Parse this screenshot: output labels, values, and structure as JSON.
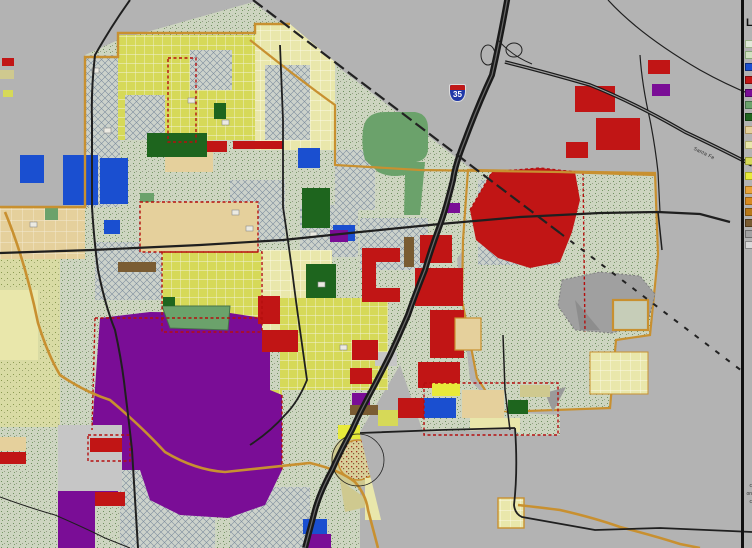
{
  "map": {
    "labels": {
      "interstate_shield": "35",
      "railroad": "Santa Fe",
      "legend_title_fragment": "L",
      "footnote_fragments": [
        "c",
        "on",
        "c"
      ]
    },
    "legend": {
      "title_fragment": "L",
      "swatches": [
        {
          "y": 40,
          "color": "#dfe8d8",
          "border": "#9ab08a"
        },
        {
          "y": 51,
          "color": "#cfe0c0",
          "border": "#88a878"
        },
        {
          "y": 63,
          "color": "#1a4fd0",
          "border": "#10307e"
        },
        {
          "y": 76,
          "color": "#c11515",
          "border": "#7d0d0d"
        },
        {
          "y": 89,
          "color": "#7a0d96",
          "border": "#4d0860"
        },
        {
          "y": 101,
          "color": "#6ba26b",
          "border": "#47714a"
        },
        {
          "y": 113,
          "color": "#1e651e",
          "border": "#124012"
        },
        {
          "y": 126,
          "color": "#e5d09c",
          "border": "#ab9462"
        },
        {
          "y": 141,
          "color": "#e9e7ab",
          "border": "#b0ad6d"
        },
        {
          "y": 157,
          "color": "#d6d958",
          "border": "#9a9c36"
        },
        {
          "y": 172,
          "color": "#e8ea3a",
          "border": "#a8aa20"
        },
        {
          "y": 186,
          "color": "#e8a33a",
          "border": "#a87420"
        },
        {
          "y": 197,
          "color": "#d88a20",
          "border": "#9a6112"
        },
        {
          "y": 208,
          "color": "#b87818",
          "border": "#82540e"
        },
        {
          "y": 219,
          "color": "#7a5c32",
          "border": "#503a1c"
        },
        {
          "y": 230,
          "color": "#a2a2a2",
          "border": "#6e6e6e"
        },
        {
          "y": 241,
          "color": "#d8d8d8",
          "border": "#888888"
        }
      ]
    },
    "palette": {
      "background_gray": "#b3b3b3",
      "agricultural_stipple": "#cdd5c0",
      "crosshatch_area": "#ccd2cb",
      "residential_yellow": "#d6d958",
      "pale_yellow": "#e9e7ab",
      "tan": "#e5d09c",
      "commercial_red": "#c11515",
      "industrial_purple": "#7a0d96",
      "park_green": "#6ba26b",
      "dark_green": "#1e651e",
      "public_blue": "#1a4fd0",
      "brown": "#7a5c32",
      "boundary_orange": "#c89030",
      "city_limit_red_dash": "#b50f0f",
      "road_black": "#1a1a1a",
      "landfill_gray": "#a0a0a0"
    }
  }
}
